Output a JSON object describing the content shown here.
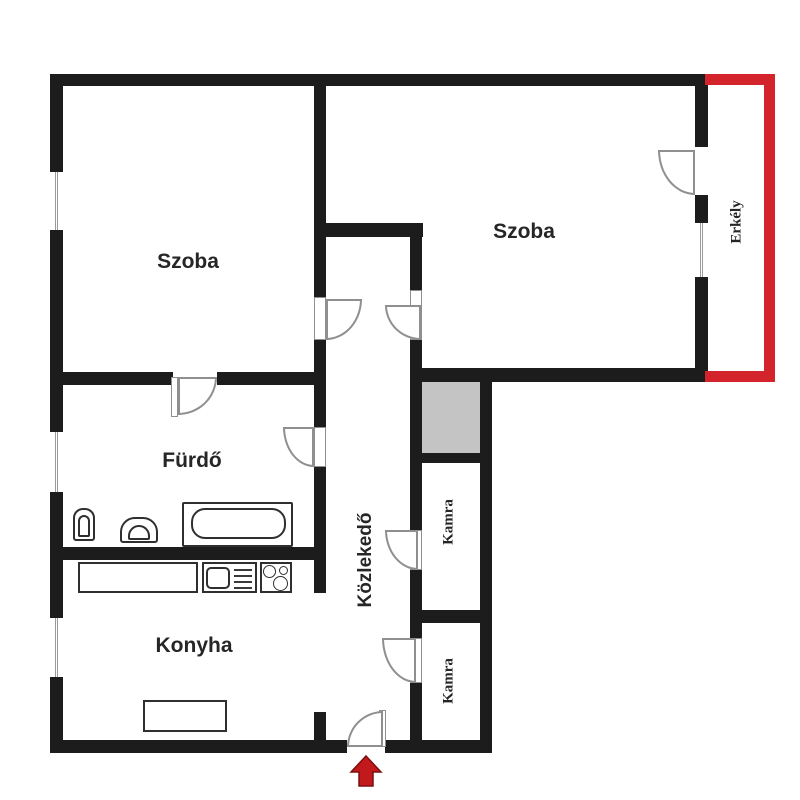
{
  "plan_title": "apartment floor plan",
  "rooms": {
    "szoba_left": {
      "label": "Szoba"
    },
    "szoba_right": {
      "label": "Szoba"
    },
    "furdo": {
      "label": "Fürdő"
    },
    "konyha": {
      "label": "Konyha"
    },
    "kozlekedo": {
      "label": "Közlekedő"
    },
    "kamra_1": {
      "label": "Kamra"
    },
    "kamra_2": {
      "label": "Kamra"
    },
    "erkely": {
      "label": "Erkély"
    }
  },
  "colors": {
    "wall": "#1c1c1c",
    "balcony_outline": "#d3232b",
    "entrance_arrow": "#c2191c",
    "shaft_fill": "#c4c4c4",
    "door_arc": "#8f8f8f",
    "fixture_outline": "#2f2f2f"
  },
  "symbols": {
    "entrance_arrow": "up-arrow marking the apartment entrance",
    "windows": 4,
    "doors": 8
  }
}
